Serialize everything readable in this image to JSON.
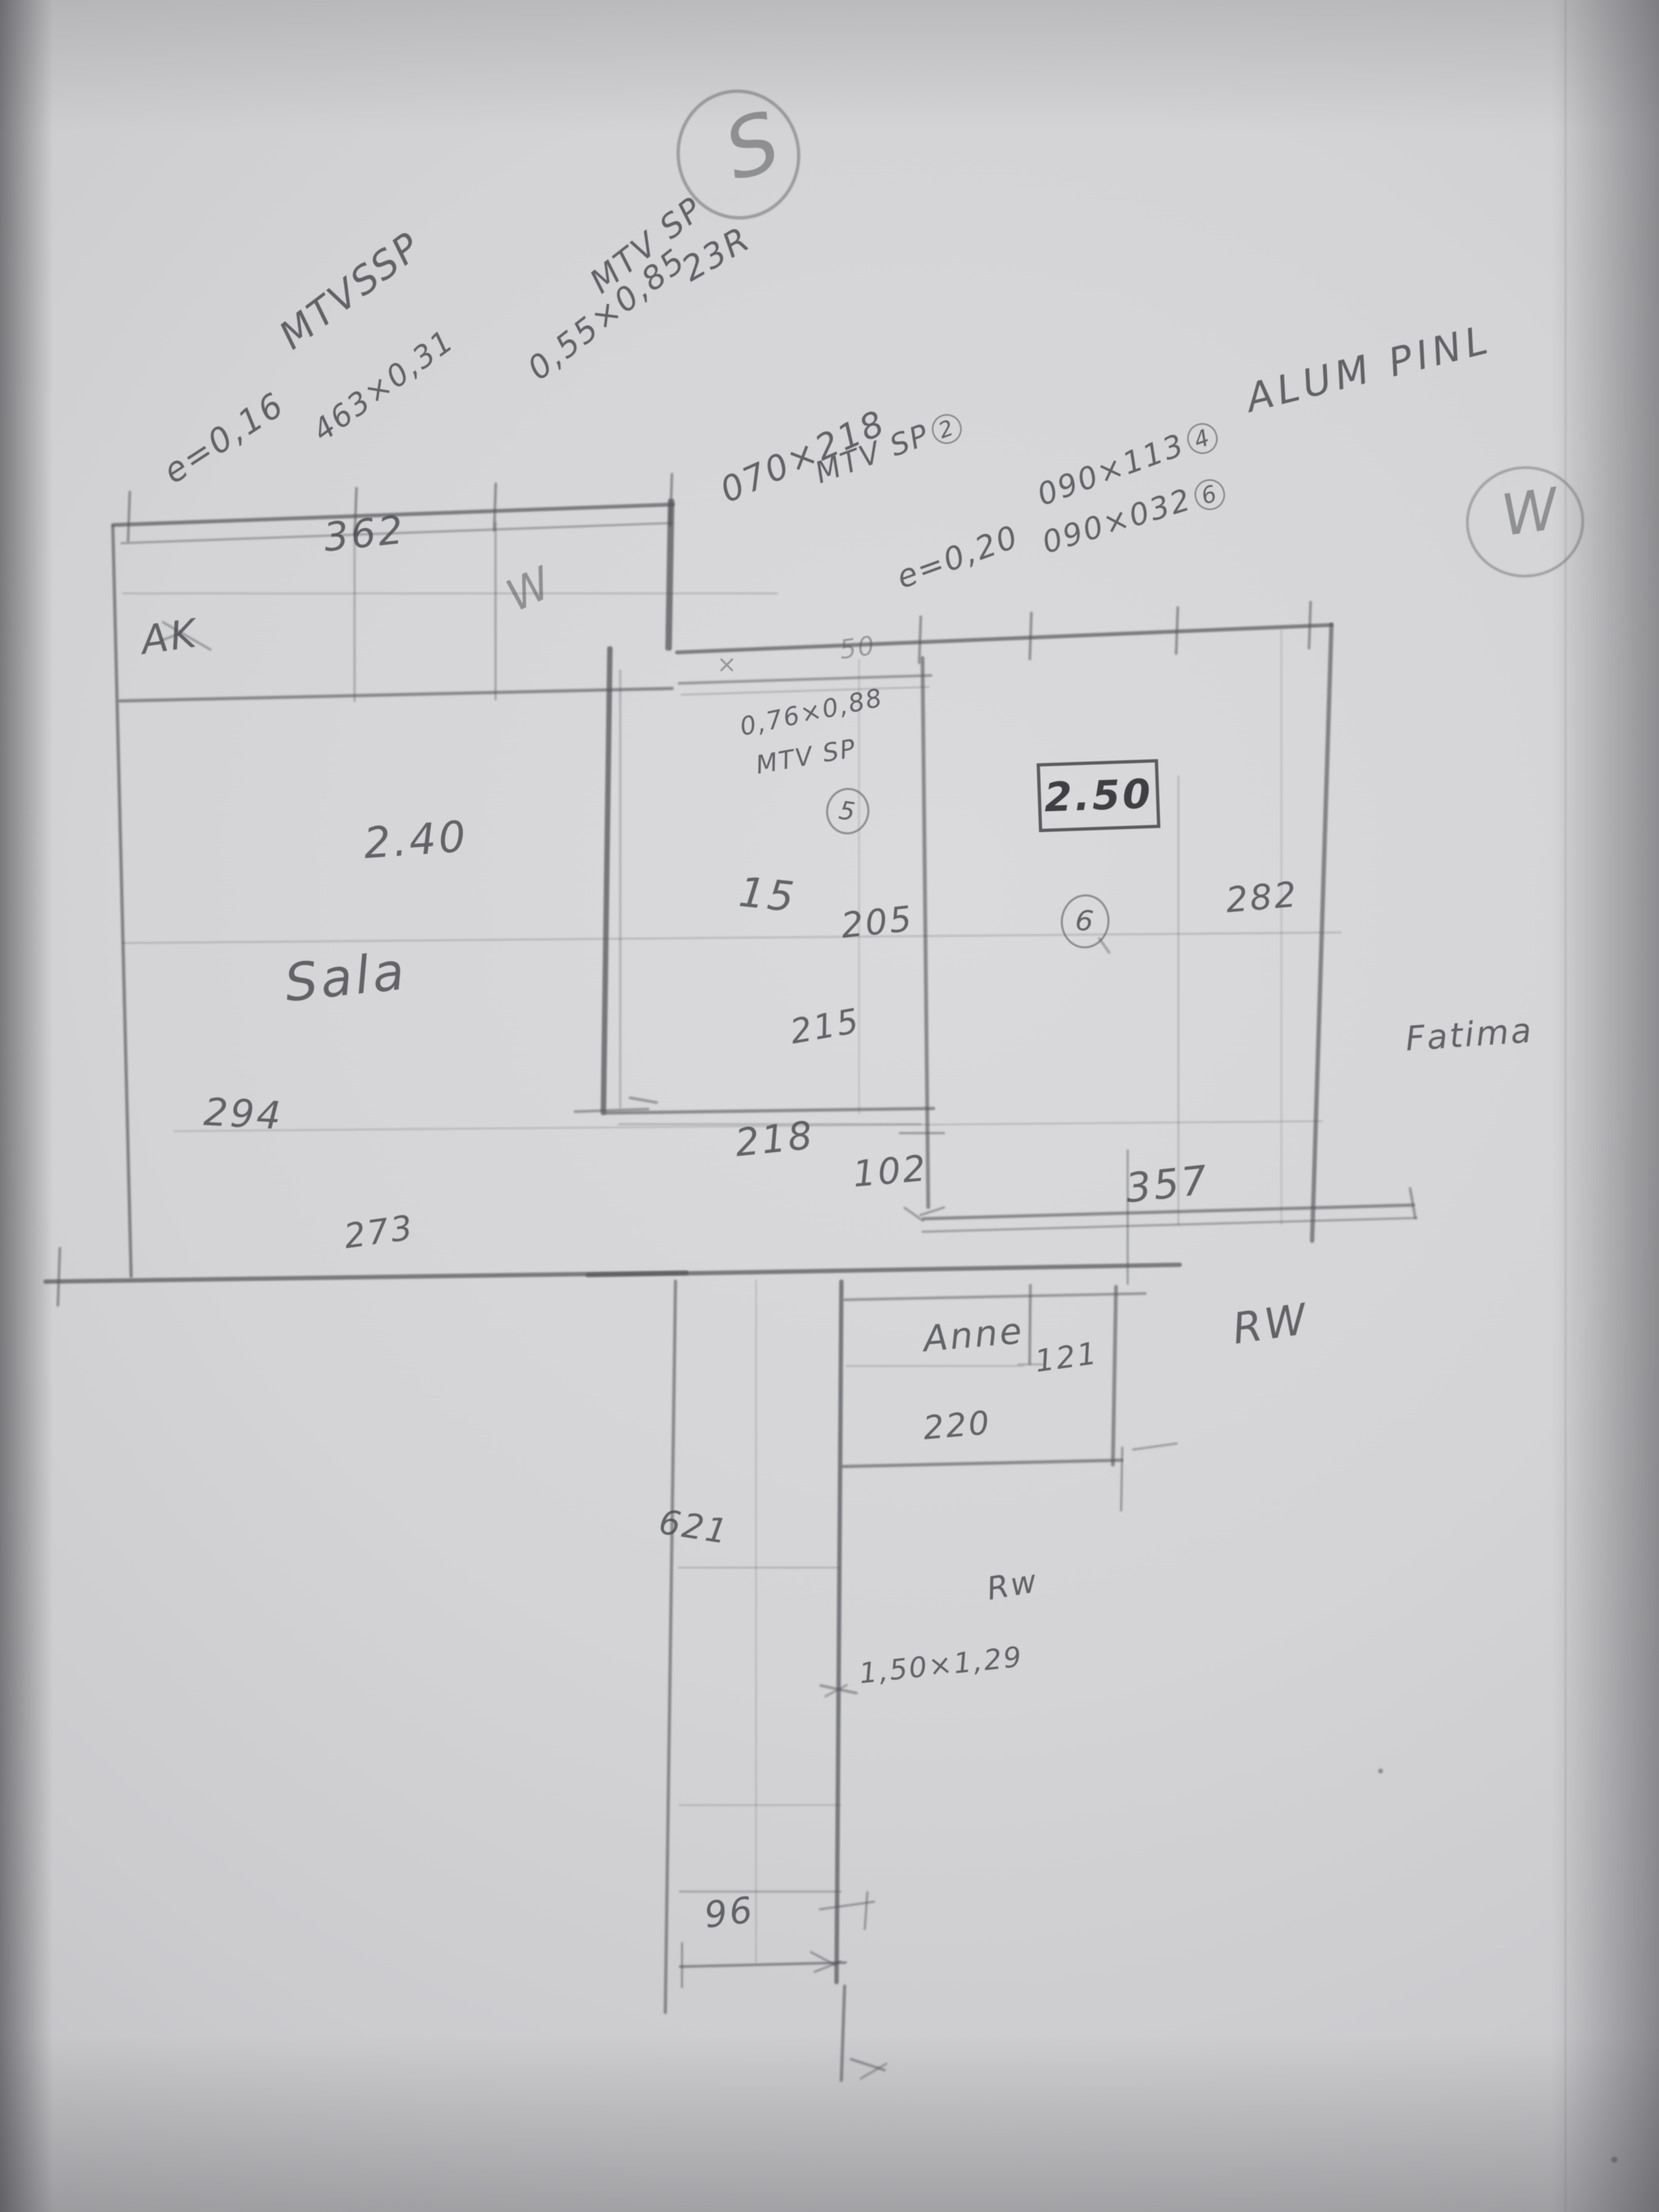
{
  "compass": {
    "south": "S",
    "west": "W"
  },
  "annotations": {
    "win_top_left": {
      "title": "MTVSSP",
      "e_value": "e=0,16",
      "size": "463×0,31"
    },
    "win_top_mid": {
      "title": "MTV SP",
      "size": "0,55×0,85",
      "code": "23R"
    },
    "door_entry": {
      "size": "070×218",
      "title": "MTV SP",
      "tag": "2"
    },
    "e20": "e=0,20",
    "win_a": {
      "size": "090×113",
      "tag": "4"
    },
    "win_b": {
      "size": "090×032",
      "tag": "6"
    },
    "material": "ALUM PINL",
    "win_mid": {
      "size": "0,76×0,88",
      "title": "MTV SP",
      "tag": "5"
    },
    "win_corridor": "1,50×1,29"
  },
  "wall_marks": {
    "cross": "×",
    "fifty": "50"
  },
  "rooms": {
    "balcony": {
      "width": "362",
      "code": "AK",
      "mark": "W"
    },
    "sala": {
      "name": "Sala",
      "height": "2.40",
      "dim_left": "294",
      "dim_bottom": "273"
    },
    "middle": {
      "dim_top": "15",
      "dim_a": "205",
      "dim_b": "215",
      "dim_c": "218",
      "dim_d": "102"
    },
    "right": {
      "height_boxed": "2.50",
      "tag": "6",
      "dim_right": "282",
      "dim_bottom": "357"
    },
    "bedroom": {
      "name": "Anne",
      "dim_right": "121",
      "dim_bottom": "220"
    },
    "corridor": {
      "length": "621",
      "width": "96"
    }
  },
  "names": {
    "owner": "Fatima",
    "rw_right": "RW",
    "rw_corridor": "Rw"
  }
}
